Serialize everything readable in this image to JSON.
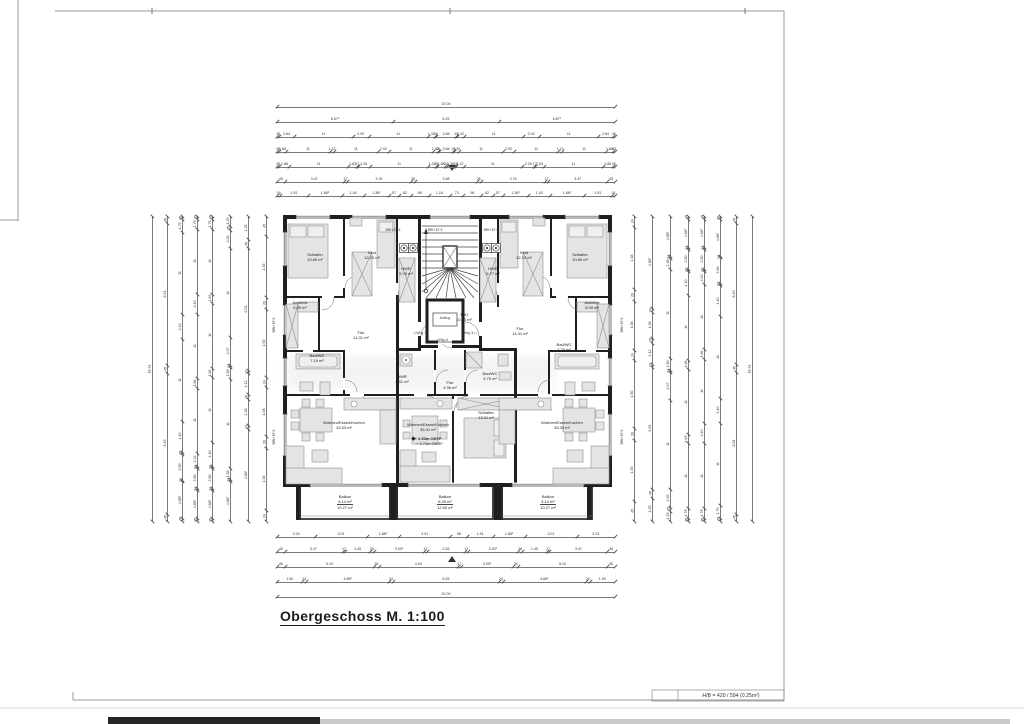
{
  "sheet": {
    "title": "Obergeschoss M. 1:100",
    "format_label": "H/B = 420 / 594 (0.25m²)"
  },
  "center": {
    "trh": {
      "name": "TRH",
      "area": "10.83 m²"
    },
    "aufzug_label": "Aufzug",
    "whg1": "◁ Whg ①",
    "whg2": "Whg ②",
    "whg3": "Whg ③ ▷",
    "brh_label": "BRH 87.5"
  },
  "apartments": {
    "left": {
      "schlafen": {
        "name": "Schlafen",
        "area": "10.89 m²"
      },
      "kind": {
        "name": "Kind",
        "area": "12.23 m²"
      },
      "hwr": {
        "name": "HWR",
        "area": "5.78 m²"
      },
      "ankleide": {
        "name": "Ankleide",
        "area": "5.09 m²"
      },
      "bad": {
        "name": "Bad/WC",
        "area": "7.19 m²"
      },
      "flur": {
        "name": "Flur",
        "area": "14.31 m²"
      },
      "wohnen": {
        "name": "Wohnen/Essen/Kochen",
        "area": "33.33 m²"
      },
      "balkon": {
        "name": "Balkon",
        "area1": "5.14 m²",
        "area2": "10.27 m²"
      }
    },
    "middle": {
      "hwr": {
        "name": "HWR",
        "area": "4.31 m²"
      },
      "flur": {
        "name": "Flur",
        "area": "4.36 m²"
      },
      "bad": {
        "name": "Bad/WC",
        "area": "5.75 m²"
      },
      "schlafen": {
        "name": "Schlafen",
        "area": "13.91 m²"
      },
      "wohnen": {
        "name": "Wohnen/Essen/Kochen",
        "area": "35.41 m²"
      },
      "level": {
        "line1": "+ 2.53m OKFF",
        "line2": "+ 2.71m OKRF"
      },
      "balkon": {
        "name": "Balkon",
        "area1": "6.25 m²",
        "area2": "12.50 m²"
      }
    },
    "right": {
      "hwr": {
        "name": "HWR",
        "area": "5.77 m²"
      },
      "kind": {
        "name": "Kind",
        "area": "12.23 m²"
      },
      "schlafen": {
        "name": "Schlafen",
        "area": "10.89 m²"
      },
      "ankleide": {
        "name": "Ankleide",
        "area": "5.09 m²"
      },
      "bad": {
        "name": "Bad/WC",
        "area": "7.78 m²"
      },
      "flur": {
        "name": "Flur",
        "area": "14.31 m²"
      },
      "wohnen": {
        "name": "Wohnen/Essen/Kochen",
        "area": "33.33 m²"
      },
      "balkon": {
        "name": "Balkon",
        "area1": "5.14 m²",
        "area2": "10.27 m²"
      }
    }
  },
  "dimensions": {
    "top": [
      [
        "20.00"
      ],
      [
        "6.87⁵",
        "6.25",
        "6.87⁵"
      ],
      [
        "45",
        "2.64",
        "11",
        "2.92",
        "11",
        "1.32",
        "26",
        "3.58",
        "26",
        "1.32",
        "11",
        "2.92",
        "11",
        "2.64",
        "45"
      ],
      [
        "45",
        "1.88",
        "11",
        "1.13",
        "11",
        "2.92",
        "11",
        "1.32",
        "26",
        "3.58",
        "26",
        "1.32",
        "11",
        "2.92",
        "11",
        "1.13",
        "11",
        "1.88",
        "45"
      ],
      [
        "45",
        "1.88",
        "11",
        "1.63",
        "17",
        "2.26",
        "11",
        "1.32",
        "26",
        "1.58",
        "24",
        "1.58",
        "26",
        "1.32",
        "11",
        "2.26",
        "17",
        "1.63",
        "11",
        "1.88",
        "45"
      ],
      [
        "45",
        "3.47",
        "17",
        "3.76",
        "26",
        "3.58",
        "26",
        "3.76",
        "17",
        "3.47",
        "45"
      ],
      [
        "18",
        "1.51",
        "1.88⁵",
        "1.18",
        "1.38⁵",
        "57",
        "62",
        "98",
        "1.18",
        "73",
        "98",
        "62",
        "57",
        "1.38⁵",
        "1.18",
        "1.88⁵",
        "1.51",
        "18"
      ]
    ],
    "bottom": [
      [
        "2.24",
        "3.01",
        "1.88⁵",
        "3.01",
        "98",
        "1.51",
        "1.88⁵",
        "3.01",
        "2.24"
      ],
      [
        "45",
        "3.47",
        "17",
        "1.45",
        "26",
        "3.00⁵",
        "17",
        "2.26",
        "17",
        "3.00⁵",
        "26",
        "1.45",
        "17",
        "3.47",
        "45"
      ],
      [
        "45",
        "5.10",
        "26",
        "4.54",
        "17",
        "3.00⁵",
        "26",
        "5.10",
        "45"
      ],
      [
        "1.50",
        "24",
        "4.88⁵",
        "24",
        "6.25",
        "24",
        "4.88⁵",
        "24",
        "1.50"
      ],
      [
        "20.00"
      ]
    ],
    "left": [
      [
        "18.31"
      ],
      [
        "45",
        "8.51",
        "45",
        "8.45",
        "45"
      ],
      [
        "45",
        "1.75",
        "11",
        "3.40",
        "11",
        "4.10",
        "26",
        "3.50",
        "24",
        "4.88⁵",
        "45"
      ],
      [
        "45",
        "1.75",
        "11",
        "3.40",
        "11",
        "1.66",
        "11",
        "2.32",
        "26",
        "3.50",
        "24",
        "4.88⁵",
        "45"
      ],
      [
        "45",
        "1.75",
        "11",
        "1.63",
        "11",
        "1.66",
        "11",
        "4.10",
        "26",
        "3.50",
        "24",
        "4.88⁵",
        "45"
      ],
      [
        "1.25",
        "45",
        "2.26",
        "11",
        "3.37",
        "24",
        "1.50",
        "11",
        "1.38",
        "24",
        "4.88⁵"
      ],
      [
        "1.25",
        "45",
        "6.51",
        "17",
        "1.12",
        "26",
        "1.38",
        "24",
        "4.88⁵"
      ],
      [
        "45",
        "1.35",
        "26",
        "1.50",
        "24",
        "1.08",
        "26",
        "1.38",
        "24"
      ]
    ],
    "right": [
      [
        "18.31"
      ],
      [
        "45",
        "8.45",
        "45",
        "8.51",
        "45"
      ],
      [
        "45",
        "4.88⁵",
        "24",
        "3.50",
        "26",
        "4.10",
        "11",
        "3.40",
        "11",
        "1.75",
        "45"
      ],
      [
        "45",
        "4.88⁵",
        "24",
        "3.50",
        "26",
        "2.32",
        "11",
        "1.66",
        "11",
        "3.40",
        "11",
        "1.75",
        "45"
      ],
      [
        "45",
        "4.88⁵",
        "24",
        "3.50",
        "26",
        "4.10",
        "11",
        "1.66",
        "11",
        "1.63",
        "11",
        "1.75",
        "45"
      ],
      [
        "4.88⁵",
        "24",
        "1.38",
        "11",
        "1.50",
        "24",
        "3.37",
        "11",
        "2.26",
        "45",
        "1.25"
      ],
      [
        "4.88⁵",
        "24",
        "1.38",
        "26",
        "1.12",
        "17",
        "6.51",
        "45",
        "1.25"
      ],
      [
        "24",
        "1.38",
        "26",
        "1.08",
        "24",
        "1.50",
        "26",
        "1.35",
        "45"
      ]
    ]
  }
}
